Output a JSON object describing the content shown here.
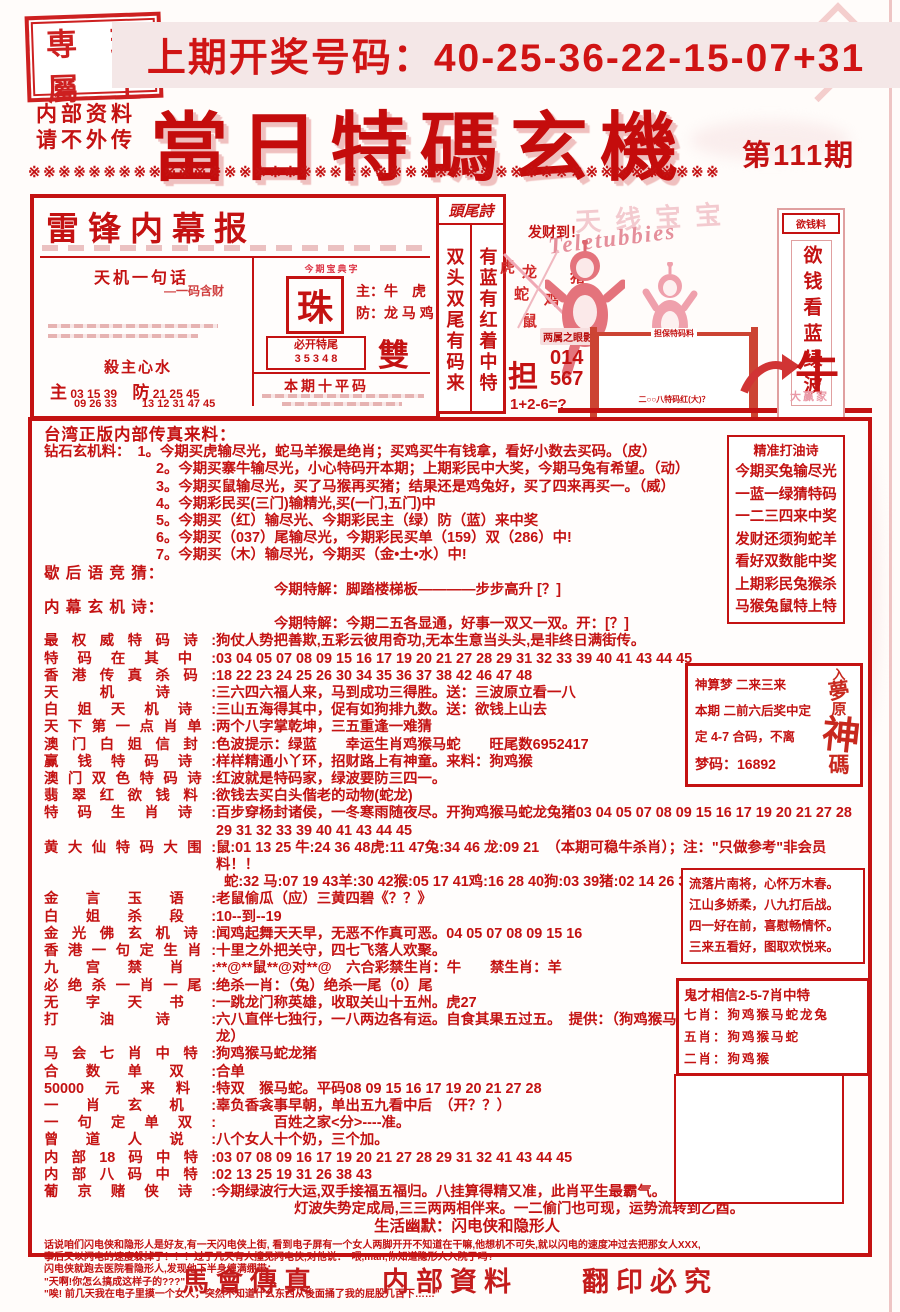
{
  "header": {
    "seal_chars": [
      "専",
      "瑞",
      "屬",
      "士"
    ],
    "banner": "上期开奖号码：40-25-36-22-15-07+31",
    "confidential_line1": "内部资料",
    "confidential_line2": "请不外传",
    "title": "當日特碼玄機",
    "issue": "第111期",
    "divider": "※※※※※※※※※※※※※※※※※※※※※※※※※※※※※※※※※※※※※※※※※※※※※※"
  },
  "leifeng_box": {
    "title": "雷锋内幕报",
    "tianji_label": "天机一句话",
    "tianji_sub": "—一码含财",
    "sha_label": "殺主心水",
    "zhu_big": "主",
    "zhu_nums": "03 15 39",
    "zhu_nums2": "09 26 33",
    "fang_big": "防",
    "fang_nums": "21 25 45",
    "fang_nums2": "13 12 31 47 45",
    "zhu_header": "今期宝典字",
    "zhu_char": "珠",
    "main_line": "主：牛　虎",
    "fang_line": "防：龙 马 鸡",
    "tail_label": "必开特尾",
    "tail_nums": "3 5 3 4 8",
    "double_single": "雙　單",
    "ten_label": "本期十平码"
  },
  "touwei": {
    "header": "頭尾詩",
    "col1": "双头双尾有码来",
    "col2": "有蓝有红着中特"
  },
  "teletubbies": {
    "faded_title": "天线宝宝",
    "script": "Teletubbies",
    "facai": "发财到！",
    "animals": [
      "虎",
      "龙",
      "猪",
      "蛇",
      "鸡",
      "鼠"
    ],
    "tag": "两属之眼影",
    "dan": "担",
    "dan_numbers": "014\n567",
    "equation": "1+2-6=?",
    "frame_label": "担保特码料",
    "frame_note": "二○○八特码红(大)？"
  },
  "money_banner": {
    "header": "欲钱料",
    "vertical": "欲钱看蓝绿波",
    "cow": "牛",
    "cow_sub": "大赢家"
  },
  "main": {
    "rows": [
      {
        "t": "intro",
        "text": "台湾正版内部传真来料："
      },
      {
        "t": "plain",
        "w": 1,
        "text": "钻石玄机料：　1。今期买虎输尽光，蛇马羊猴是绝肖；买鸡买牛有钱拿，看好小数去买码。（皮）"
      },
      {
        "t": "num",
        "w": 1,
        "text": "2。今期买寨牛输尽光，小心特码开本期；上期彩民中大奖，今期马兔有希望。（动）"
      },
      {
        "t": "num",
        "w": 1,
        "text": "3。今期买鼠输尽光，买了马猴再买猪；结果还是鸡兔好，买了四来再买一。（威）"
      },
      {
        "t": "num",
        "w": 1,
        "text": "4。今期彩民买(三门)输精光,买(一门,五门)中"
      },
      {
        "t": "num",
        "w": 1,
        "text": "5。今期买（红）输尽光、今期彩民主（绿）防（蓝）来中奖"
      },
      {
        "t": "num",
        "w": 1,
        "text": "6。今期买（037）尾输尽光，今期彩民买单（159）双（286）中!"
      },
      {
        "t": "num",
        "w": 1,
        "text": "7。今期买（木）输尽光，今期买（金•土•水）中!"
      },
      {
        "t": "hdr",
        "text": "歇 后 语 竞 猜："
      },
      {
        "t": "mid",
        "text": "今期特解：脚踏楼梯板————步步高升 [？]"
      },
      {
        "t": "hdr",
        "text": "内 幕 玄 机 诗："
      },
      {
        "t": "mid",
        "text": "今期特解：今期二五各显通，好事一双又一双。开：[？]"
      },
      {
        "t": "lab",
        "w": 1,
        "label": "最权威特码诗",
        "text": "狗仗人势把善欺,五彩云彼用奇功,无本生意当头头,是非终日满街传。"
      },
      {
        "t": "lab",
        "w": 1,
        "label": "特码在其中",
        "text": "03 04 05 07 08 09 15 16 17 19 20 21 27 28 29 31 32 33 39 40 41 43 44 45"
      },
      {
        "t": "lab",
        "label": "香港传真杀码",
        "text": "18 22 23 24 25 26 30 34 35 36 37 38 42 46 47 48"
      },
      {
        "t": "lab",
        "label": "天机诗",
        "text": "三六四六福人来，马到成功三得胜。送：三波原立看一八"
      },
      {
        "t": "lab",
        "label": "白姐天机诗",
        "text": "三山五海得其中，促有如狗排九数。送：欲钱上山去"
      },
      {
        "t": "lab",
        "label": "天下第一点肖单",
        "text": "两个八字掌乾坤，三五重逢一难猜"
      },
      {
        "t": "lab",
        "label": "澳门白姐信封",
        "text": "色波提示：绿蓝　　幸运生肖鸡猴马蛇　　旺尾数6952417"
      },
      {
        "t": "lab",
        "label": "赢钱特码诗",
        "text": "样样精通小丫环，招财路上有神童。来料：狗鸡猴"
      },
      {
        "t": "lab",
        "label": "澳门双色特码诗",
        "text": "红波就是特码家，绿波要防三四一。"
      },
      {
        "t": "lab",
        "label": "翡翠红欲钱料",
        "text": "欲钱去买白头偕老的动物(蛇龙)"
      },
      {
        "t": "lab",
        "w": 1,
        "label": "特码生肖诗",
        "text": "百步穿杨封诸侯，一冬寒雨随夜尽。开狗鸡猴马蛇龙兔猪03 04 05 07 08 09 15 16 17 19 20 21 27 28 29 31 32 33 39 40 41 43 44 45"
      },
      {
        "t": "lab",
        "w": 1,
        "label": "黄大仙特码大围",
        "text": "鼠:01 13 25 牛:24 36 48虎:11 47兔:34 46 龙:09 21　（本期可稳牛杀肖）；注：\"只做参考\"非会员料！！"
      },
      {
        "t": "cont",
        "w": 1,
        "text": "蛇:32 马:07 19 43羊:30 42猴:05 17 41鸡:16 28 40狗:03 39猪:02 14 26 38"
      },
      {
        "t": "lab",
        "label": "金言玉语",
        "text": "老鼠偷瓜（应）三黄四碧《？？》"
      },
      {
        "t": "lab",
        "label": "白姐杀段",
        "text": "10--到--19"
      },
      {
        "t": "lab",
        "label": "金光佛玄机诗",
        "text": "闻鸡起舞天天早，无恶不作真可恶。04 05 07 08 09 15 16"
      },
      {
        "t": "lab",
        "label": "香港一句定生肖",
        "text": "十里之外把关守，四七飞落人欢聚。"
      },
      {
        "t": "lab",
        "label": "九宫禁肖",
        "text": "**@**鼠**@对**@　六合彩禁生肖：牛　　禁生肖：羊"
      },
      {
        "t": "lab",
        "label": "必绝杀一肖一尾",
        "text": "绝杀一肖：（兔）绝杀一尾（0）尾"
      },
      {
        "t": "lab",
        "label": "无字天书",
        "text": "一跳龙门称英雄，收取关山十五州。虎27"
      },
      {
        "t": "lab",
        "label": "打油诗",
        "text": "六八直伴七独行，一八两边各有运。自食其果五过五。　提供：（狗鸡猴马蛇龙）"
      },
      {
        "t": "lab",
        "label": "马会七肖中特",
        "text": "狗鸡猴马蛇龙猪"
      },
      {
        "t": "lab",
        "label": "合数单双",
        "text": "合单"
      },
      {
        "t": "lab",
        "label": "50000元来料",
        "text": "特双　猴马蛇。平码08 09 15 16 17 19 20 21 27 28"
      },
      {
        "t": "lab",
        "label": "一肖玄机",
        "text": "辜负香衾事早朝，单出五九看中后　（开？？）"
      },
      {
        "t": "lab",
        "label": "一句定单双",
        "text": "　　　　百姓之家<分>----准。"
      },
      {
        "t": "lab",
        "label": "曾道人说",
        "text": "八个女人十个奶，三个加。"
      },
      {
        "t": "lab",
        "label": "内部18码中特",
        "text": "03 07 08 09 16 17 19 20 21 27 28 29 31 32 41 43 44 45"
      },
      {
        "t": "lab",
        "label": "内部八码中特",
        "text": "02 13 25 19 31 26 38 43"
      },
      {
        "t": "lab",
        "w": 1,
        "label": "葡京赌侠诗",
        "text": "今期绿波行大运,双手接福五福归。八挂算得精又准，此肖平生最霸气。"
      },
      {
        "t": "mid2",
        "text": "灯波失势定成局,三三两两相伴来。一二偷门也可现，运势流转到乙酉。"
      },
      {
        "t": "mid3",
        "text": "生活幽默：闪电侠和隐形人"
      }
    ],
    "humor_lines": [
      "话说咱们闪电侠和隐形人是好友,有一天闪电侠上街, 看到电子屏有一个女人两脚开开不知道在干嘛,他想机不可失,就以闪电的速度冲过去把那女人XXX,",
      "事后又以闪电的速度躲掉了！！！过了几天有人撞见闪电侠,对他说：\"喂,man,你知道隐形人入院了吗?\"",
      "闪电侠就跑去医院看隐形人,发现他下半身缠满绷带：",
      "\"天啊!你怎么搞成这样子的???\"",
      "\"唉! 前几天我在电子里摸一个女人，突然不知道什么东西从後面捅了我的屁股几百下……\""
    ]
  },
  "right_boxes": {
    "dayou": {
      "title": "精准打油诗",
      "lines": [
        "今期买兔输尽光",
        "一蓝一绿猜特码",
        "一二三四来中奖",
        "发财还须狗蛇羊",
        "看好双数能中奖",
        "上期彩民兔猴杀",
        "马猴兔鼠特上特"
      ]
    },
    "dream": {
      "line1": "神算梦 二来三来",
      "line2": "本期 二前六后奖中定",
      "line3": "定 4-7 合码，不离",
      "line4": "梦码：16892",
      "vertical": "入夢原神碼"
    },
    "verse": {
      "lines": [
        "流落片南将，心怀万木春。",
        "江山多娇柔，八九打后战。",
        "四一好在前，喜慰畅情怀。",
        "三来五看好，图取欢悦来。"
      ]
    },
    "guicai": {
      "title": "鬼才相信2-5-7肖中特",
      "lines": [
        "七肖：狗鸡猴马蛇龙兔",
        "五肖：狗鸡猴马蛇",
        "二肖：狗鸡猴"
      ]
    }
  },
  "footer": {
    "items": [
      "馬會傳真",
      "内部資料",
      "翻印必究"
    ]
  },
  "colors": {
    "red": "#c41212",
    "pink": "#e8909a",
    "banner_bg": "#f4e7e7"
  }
}
